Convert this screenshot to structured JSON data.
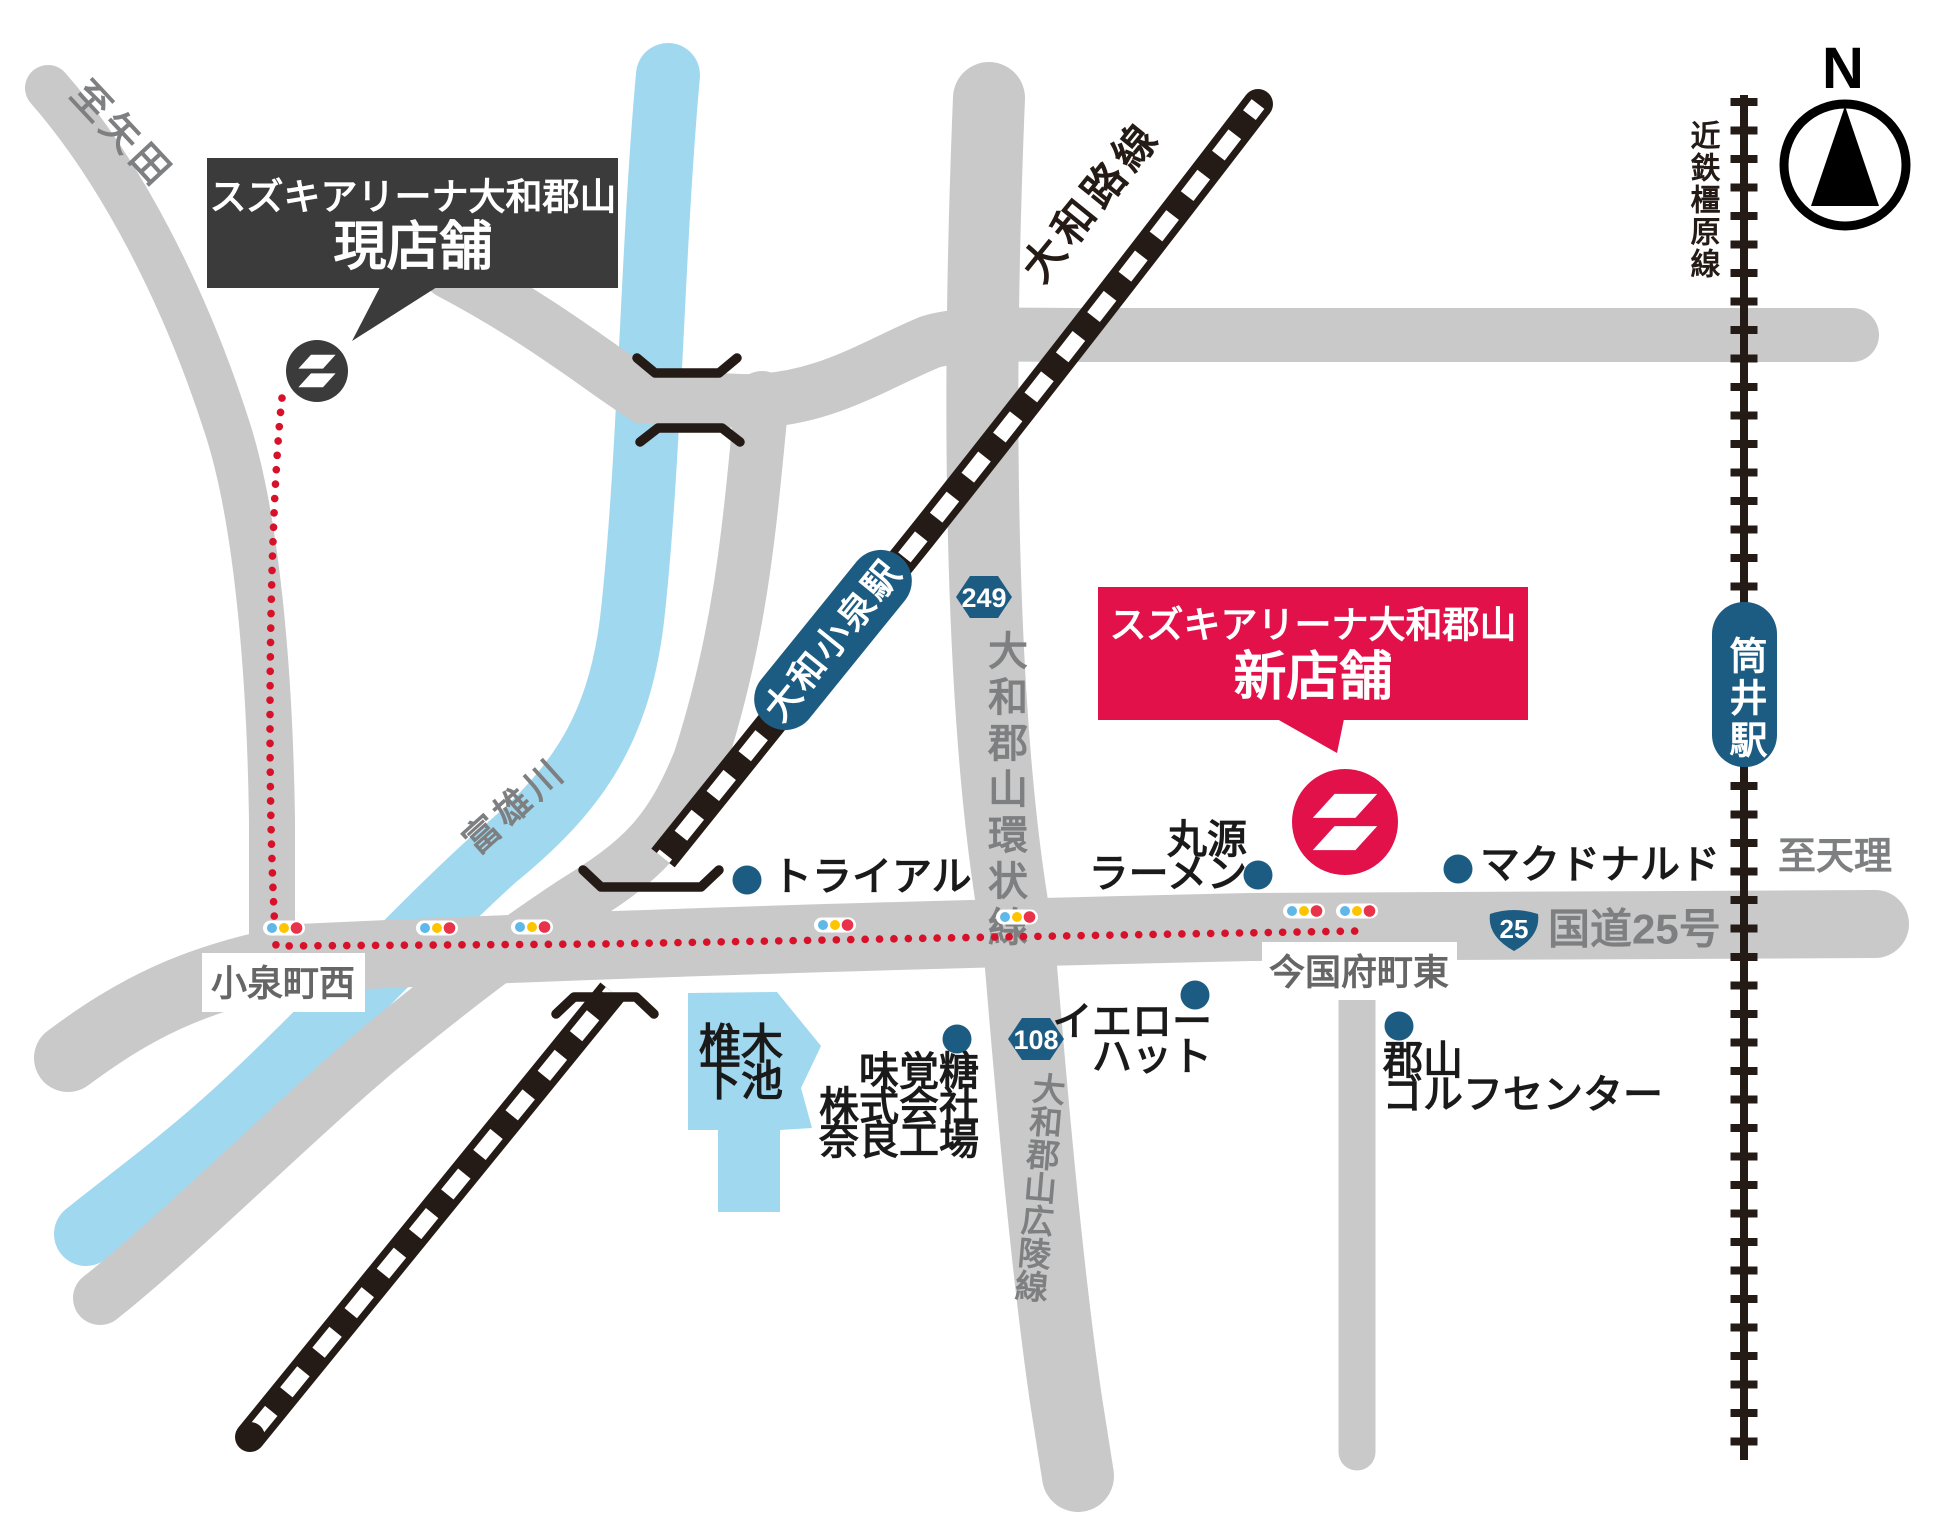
{
  "map": {
    "compass_label": "N",
    "callouts": {
      "current_store": {
        "line1": "スズキアリーナ大和郡山",
        "line2": "現店舗"
      },
      "new_store": {
        "line1": "スズキアリーナ大和郡山",
        "line2": "新店舗"
      }
    },
    "railways": {
      "yamatoji_line": "大和路線",
      "kintetsu_kashihara_line": "近鉄橿原線"
    },
    "stations": {
      "yamato_koizumi": "大和小泉駅",
      "tsutsui": "筒井駅"
    },
    "roads": {
      "ring_road": "大和郡山環状線",
      "koryo_road": "大和郡山広陵線",
      "route25_label": "国道25号",
      "badge_249": "249",
      "badge_108": "108",
      "badge_25": "25"
    },
    "directions": {
      "to_yata": "至矢田",
      "to_tenri": "至天理"
    },
    "river_name": "富雄川",
    "pond": {
      "line1": "椎木",
      "line2": "下池"
    },
    "intersections": {
      "koizumicho_nishi": "小泉町西",
      "imagoko_cho_higashi": "今国府町東"
    },
    "pois": [
      {
        "id": "trial",
        "lines": [
          "トライアル"
        ]
      },
      {
        "id": "marugen-ramen",
        "lines": [
          "丸源",
          "ラーメン"
        ]
      },
      {
        "id": "mcdonalds",
        "lines": [
          "マクドナルド"
        ]
      },
      {
        "id": "yellow-hat",
        "lines": [
          "イエロー",
          "ハット"
        ]
      },
      {
        "id": "koriyama-golf-center",
        "lines": [
          "郡山",
          "ゴルフセンター"
        ]
      },
      {
        "id": "mikakuto-nara-factory",
        "lines": [
          "味覚糖",
          "株式会社",
          "奈良工場"
        ]
      }
    ],
    "colors": {
      "road_gray": "#c9c9c9",
      "river_blue": "#a0d8ef",
      "rail_black": "#251b16",
      "brand_blue": "#1d5c82",
      "accent_red": "#e2114a",
      "callout_dark": "#3b3b3b",
      "route_dot_red": "#d8112b",
      "signal_blue": "#5fb8e8",
      "signal_yellow": "#fdc500",
      "signal_red": "#e8334a",
      "gray_text": "#7e7f80"
    }
  }
}
